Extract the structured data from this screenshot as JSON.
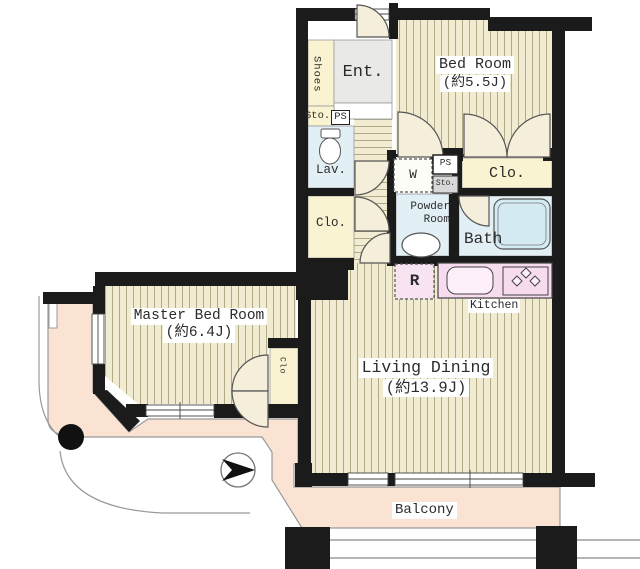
{
  "plan_title": "apartment floor plan",
  "colors": {
    "wall": "#1b1b1b",
    "wood_floor": "#f1ebd1",
    "cream_room": "#faf3d2",
    "water_room": "#e2eff5",
    "kitchen_pink": "#f7dbef",
    "balcony_peach": "#fbe3d3",
    "entrance_gray": "#e9e9e7"
  },
  "labels": {
    "shoes": "Shoes",
    "entrance": "Ent.",
    "storage_hall": "Sto.",
    "ps_hall": "PS",
    "lavatory": "Lav.",
    "closet_hall": "Clo.",
    "bed_room": {
      "name": "Bed Room",
      "size": "(約5.5J)"
    },
    "closet_bedroom": "Clo.",
    "ps_shaft": "PS",
    "sto_shaft": "Sto.",
    "washer": "W",
    "powder_room": {
      "line1": "Powder",
      "line2": "Room"
    },
    "bath": "Bath",
    "refrigerator": "R",
    "kitchen": "Kitchen",
    "master_bed_room": {
      "name": "Master Bed Room",
      "size": "(約6.4J)"
    },
    "closet_master": "Clo",
    "living_dining": {
      "name": "Living Dining",
      "size": "(約13.9J)"
    },
    "balcony": "Balcony"
  }
}
